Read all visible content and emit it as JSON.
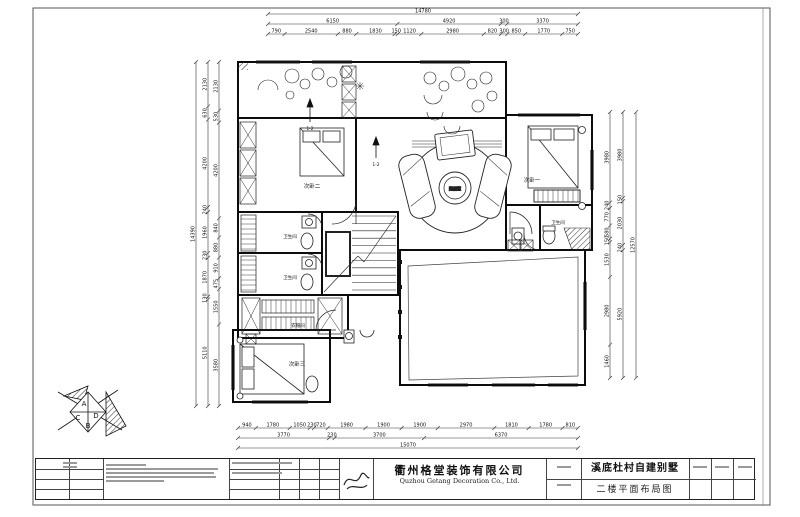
{
  "sheet": {
    "company_cn": "衢州格堂装饰有限公司",
    "company_en": "Quzhou Getang Decoration Co., Ltd.",
    "project": "溪底杜村自建别墅",
    "drawing": "二楼平面布局图"
  },
  "rooms": {
    "bedroom2": "次卧二",
    "bedroom1": "次卧一",
    "bedroom3": "次卧三",
    "bath_right": "卫生间",
    "bath_mid1": "卫生间",
    "bath_mid2": "卫生间",
    "cloak": "衣帽间",
    "sitting": "起居室",
    "section1": "1-2",
    "section2": "1-2"
  },
  "compass": {
    "a": "A",
    "b": "B",
    "c": "C",
    "d": "D"
  },
  "dims": {
    "top": [
      [
        "14780"
      ],
      [
        "6150",
        "4920",
        "300",
        "3370"
      ],
      [
        "790",
        "2540",
        "880",
        "1830",
        "150",
        "1120",
        "2980",
        "820",
        "300",
        "850",
        "1770",
        "750"
      ]
    ],
    "bottom": [
      [
        "940",
        "1780",
        "1050",
        "230",
        "720",
        "1980",
        "1900",
        "1900",
        "2970",
        "1810",
        "1780",
        "810"
      ],
      [
        "3770",
        "230",
        "3700",
        "6370"
      ],
      [
        "15070"
      ]
    ],
    "left": [
      [
        "14390"
      ],
      [
        "2130",
        "630",
        "4200",
        "240",
        "1960",
        "230",
        "1870",
        "130",
        "5110"
      ],
      [
        "2130",
        "530",
        "4200",
        "840",
        "880",
        "910",
        "475",
        "1550",
        "3580"
      ]
    ],
    "right": [
      [
        "3980",
        "240",
        "770",
        "580",
        "150",
        "1530",
        "2980",
        "1460"
      ],
      [
        "3980",
        "150",
        "2030",
        "240",
        "5920"
      ],
      [
        "12570"
      ]
    ]
  }
}
